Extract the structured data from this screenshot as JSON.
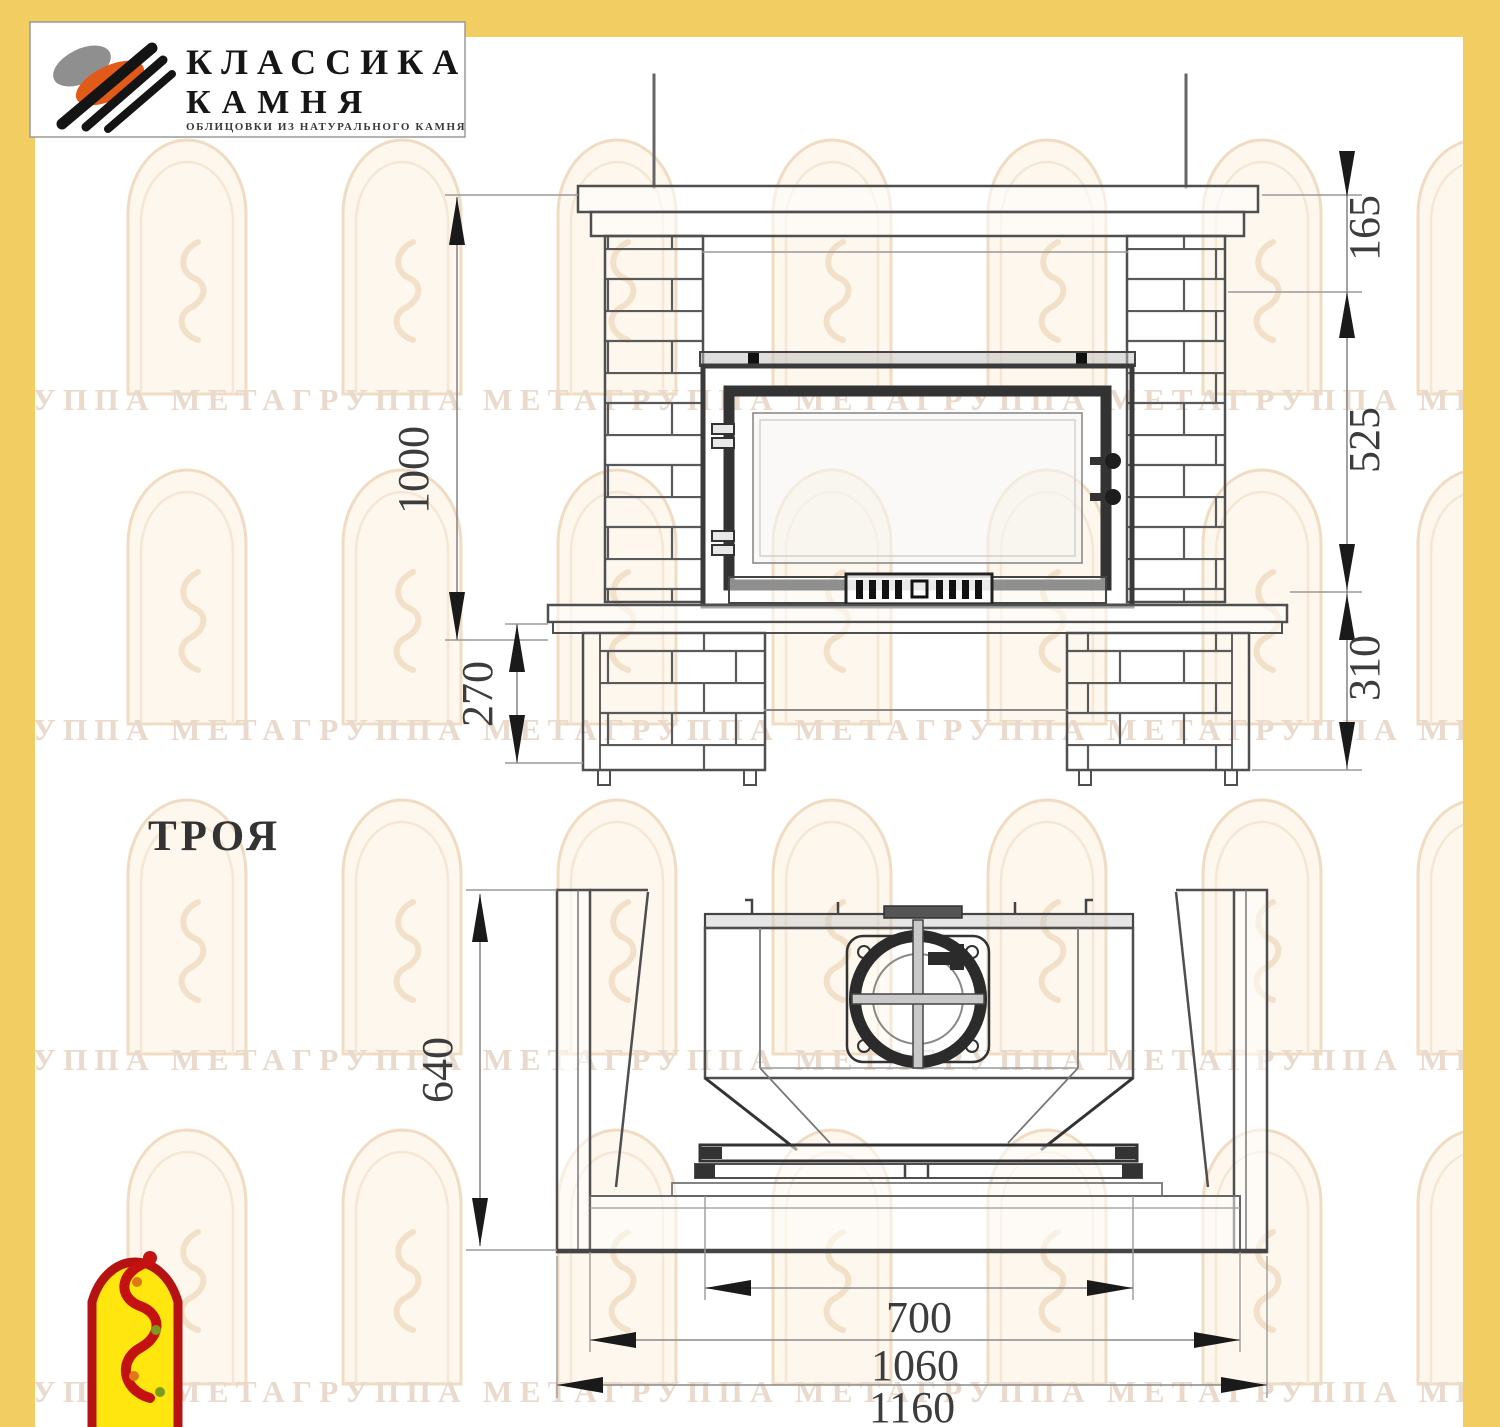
{
  "page": {
    "border_color": "#f2cd62",
    "model_name": "ТРОЯ"
  },
  "brand": {
    "name_line1": "КЛАССИКА",
    "name_line2": "КАМНЯ",
    "tagline": "ОБЛИЦОВКИ ИЗ НАТУРАЛЬНОГО КАМНЯ",
    "icon_gray": "#8f8f8f",
    "icon_orange": "#e25a17",
    "icon_black": "#141414"
  },
  "watermark": {
    "text": "ГРУППА МЕТАГРУППА МЕТАГРУППА МЕТАГРУППА МЕТАГРУППА МЕТА",
    "color": "#e9dacd"
  },
  "front_view": {
    "dim_total_height": "1000",
    "dim_pedestal_height": "270",
    "dim_top_zone": "165",
    "dim_firebox_zone": "525",
    "dim_base_zone": "310"
  },
  "plan_view": {
    "dim_depth": "640",
    "dim_firebox_width": "700",
    "dim_slab_width": "1060",
    "dim_overall_width": "1160"
  },
  "footer_logo": {
    "arch_red": "#b51313",
    "fill_yellow": "#ffe60f"
  }
}
